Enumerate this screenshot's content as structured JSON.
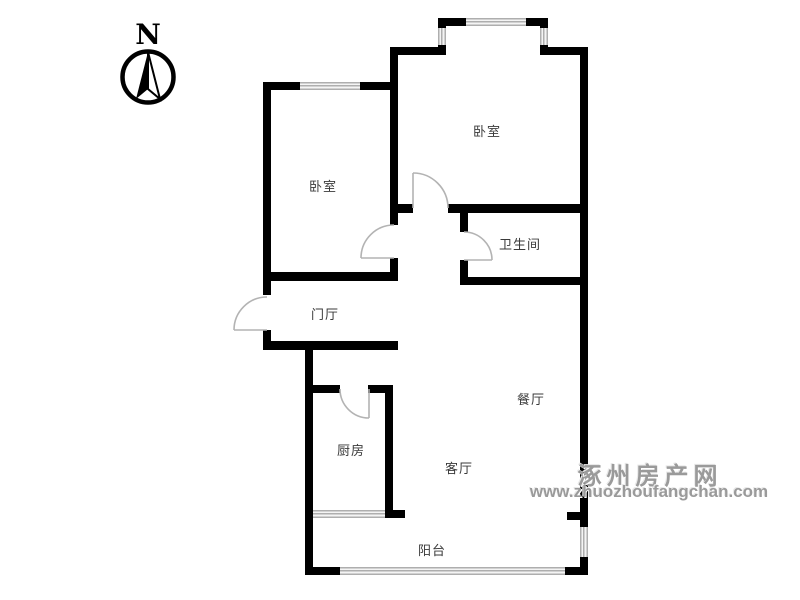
{
  "compass": {
    "label": "N"
  },
  "rooms": {
    "bedroom_top": "卧室",
    "bedroom_left": "卧室",
    "bathroom": "卫生间",
    "entry_hall": "门厅",
    "dining": "餐厅",
    "kitchen": "厨房",
    "living": "客厅",
    "balcony": "阳台"
  },
  "watermark": {
    "site_name": "涿州房产网",
    "site_url": "www.zhuozhoufangchan.com"
  },
  "colors": {
    "wall": "#000000",
    "window_line": "#aeaeae",
    "door_line": "#b3b3b3",
    "label_text": "#3a3a3a",
    "watermark_gray": "#9a9a9a"
  }
}
